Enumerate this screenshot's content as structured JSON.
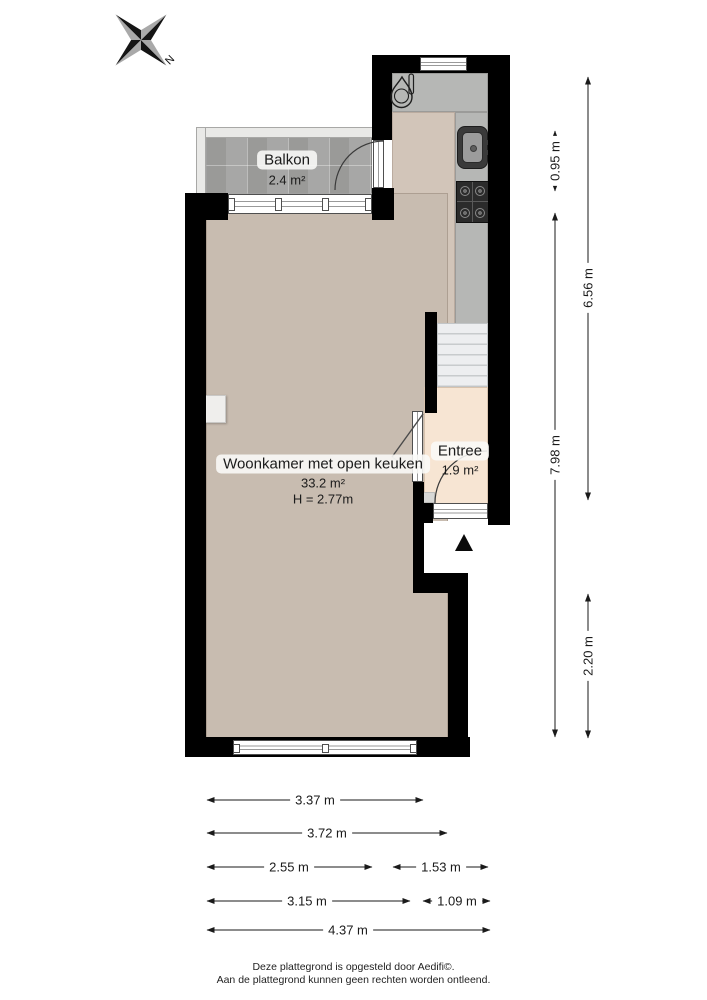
{
  "compass": {
    "north_label": "N"
  },
  "rooms": {
    "balkon": {
      "name": "Balkon",
      "area": "2.4 m²"
    },
    "woonkamer": {
      "name": "Woonkamer met open keuken",
      "area": "33.2 m²",
      "ceiling": "H = 2.77m"
    },
    "entree": {
      "name": "Entree",
      "area": "1.9 m²"
    }
  },
  "dimensions": {
    "right": [
      "0.95 m",
      "7.98 m",
      "6.56 m",
      "2.20 m"
    ],
    "bottom": [
      "3.37 m",
      "3.72 m",
      "2.55 m",
      "1.53 m",
      "3.15 m",
      "1.09 m",
      "4.37 m"
    ]
  },
  "footer": {
    "line1": "Deze plattegrond is opgesteld door Aedifi©.",
    "line2": "Aan de plattegrond kunnen geen rechten worden ontleend."
  },
  "colors": {
    "wall": "#000000",
    "living_floor": "#c8bcb0",
    "kitchen_floor": "#d2c5b9",
    "entree_floor": "#f7e5d3",
    "balcony_tile": "#a2a2a0",
    "counter": "#b6b7b5",
    "stairs": "#edeef0",
    "dimension_text": "#1a1a1a"
  }
}
